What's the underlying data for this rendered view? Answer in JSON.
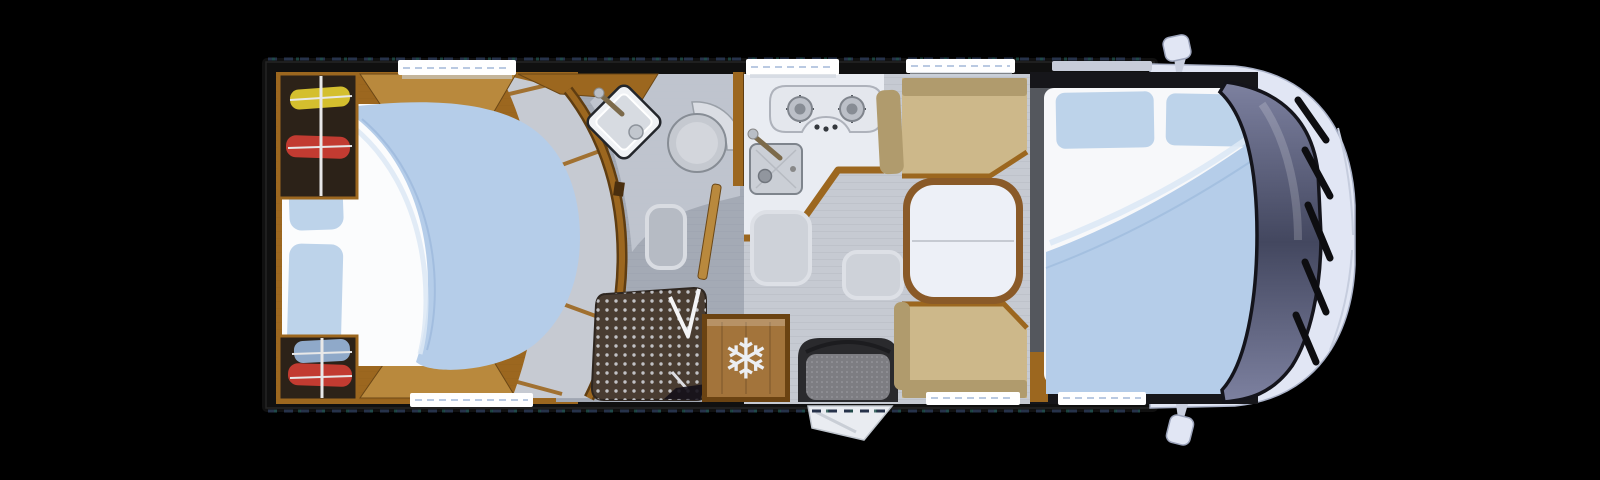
{
  "scene": {
    "subject": "motorhome-floorplan-top-view",
    "features": [
      "rear-island-bed",
      "wardrobe-top",
      "wardrobe-bottom",
      "curved-bathroom-wall",
      "corner-washbasin",
      "swivel-toilet",
      "shower-tray",
      "bathroom-door",
      "two-burner-hob",
      "kitchen-sink",
      "kitchen-counter",
      "refrigerator",
      "entry-seat",
      "entry-step",
      "dinette-bench-top",
      "dinette-bench-bottom",
      "split-table",
      "drop-down-front-bed",
      "cab-windshield",
      "wipers",
      "wing-mirror-top",
      "wing-mirror-bottom",
      "windows"
    ]
  },
  "fridge": {
    "icon_name": "snowflake-icon",
    "icon_glyph": "❄"
  },
  "colors": {
    "bg": "#000000",
    "hull": "#101010",
    "wall_dash_blue": "#26324a",
    "wall_dash_teal": "#1e4f49",
    "wood": "#9c671f",
    "wood_dark": "#5f3d11",
    "wood_light": "#b9893d",
    "floor": "#c6cad2",
    "bath_floor": "#a4aab5",
    "bath_floor_light": "#c2c7d0",
    "mattress": "#f7f8fa",
    "pillow": "#bdd3ea",
    "duvet": "#b5cde9",
    "duvet_fold": "#dce8f5",
    "bench": "#cdb88a",
    "bench_dark": "#b09b6d",
    "table_rim": "#8a5a28",
    "table_top": "#edf0f7",
    "counter": "#e9ecf2",
    "shower_floor": "#493c31",
    "shower_dot": "#d6d9de",
    "fridge_wood": "#a3743b",
    "icon_white": "#eceff3",
    "seat_dark": "#2a2a2d",
    "seat_fabric": "#7d7d82",
    "cab_body": "#e1e6f4",
    "glass_light": "#7d81a0",
    "glass_dark": "#43475f",
    "wiper": "#0d0d10",
    "window": "#ffffff",
    "clothes_yellow": "#d4bf2e",
    "clothes_red": "#c23b31",
    "clothes_blue": "#8fa9c9",
    "rail_white": "#e8e8e8",
    "wardrobe_interior": "#2c2218"
  }
}
